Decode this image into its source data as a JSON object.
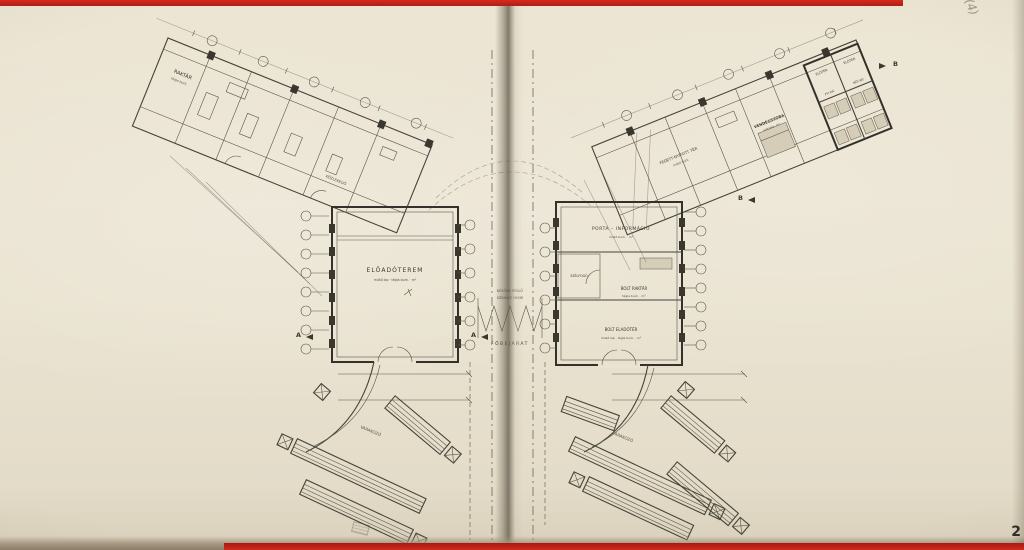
{
  "document": {
    "type": "scanned architectural floor plan, two-page book spread",
    "page_number": "2",
    "pencil_mark": "(4)"
  },
  "colors": {
    "paper": "#eae3d1",
    "ink": "#46433a",
    "wall_ink": "#34312a",
    "red_edge": "#c4231b",
    "gutter_shadow": "#58504236"
  },
  "left_plan": {
    "wing_room_label": "RAKTÁR",
    "wing_room_sub": "tégla burk.",
    "corridor_label": "KÖZLEKEDŐ",
    "hall_label": "ELŐADÓTEREM",
    "hall_sub": "műkő lap · tégla burk. · m²",
    "waiting_label": "VÁRAKOZÓ",
    "section_marker": "A"
  },
  "center": {
    "note_line1": "KÉSŐBB ÉPÜLŐ",
    "note_line2": "SZÍNHÁZ HELYE",
    "entrance_label": "FŐBEJÁRAT"
  },
  "right_plan": {
    "porta_label": "PORTA – INFORMÁCIÓ",
    "porta_sub": "műkő burk. · m²",
    "szelfogo_label": "SZÉLFOGÓ",
    "bolt_raktar_label": "BOLT RAKTÁR",
    "bolt_raktar_sub": "tégla burk. · m²",
    "bolt_eladoter_label": "BOLT ELADÓTÉR",
    "bolt_eladoter_sub": "műkő lap · tégla burk. · m²",
    "fedett_label": "FEDETT-NYITOTT TÉR",
    "fedett_sub": "műkő burk.",
    "vendegszoba_label": "VENDÉGSZOBA",
    "vendegszoba_sub": "szőnyeg · m²",
    "eloter1_label": "ELŐTÉR",
    "eloter2_label": "ELŐTÉR",
    "ffi_wc_label": "FFI WC",
    "noi_wc_label": "NŐI WC",
    "waiting_label": "VÁRAKOZÓ",
    "section_marker": "B"
  }
}
